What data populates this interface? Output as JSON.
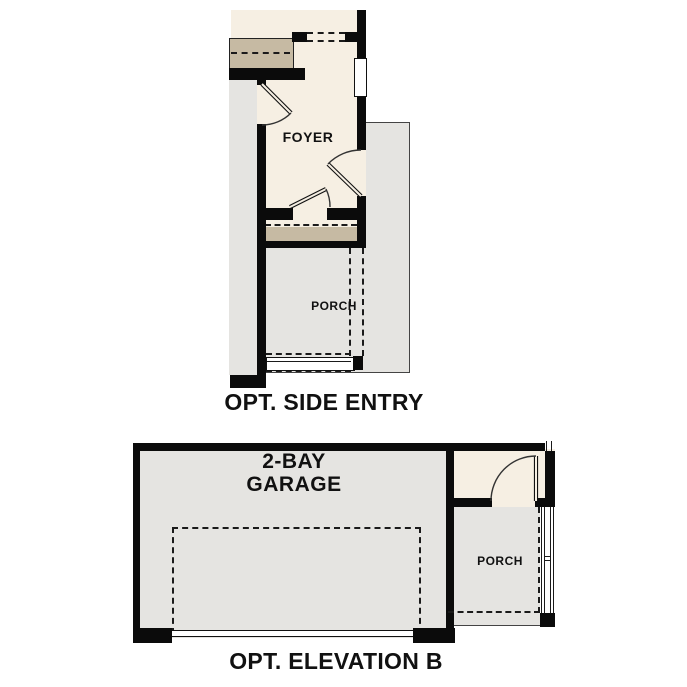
{
  "colors": {
    "background": "#FFFFFF",
    "wall": "#0B0B0B",
    "floor_cream": "#F6EFE3",
    "stair_tan": "#C6BAA3",
    "concrete_gray": "#E5E4E1",
    "line_ink": "#1A1A1A",
    "text": "#111111"
  },
  "side_entry_plan": {
    "title": "OPT. SIDE ENTRY",
    "foyer_label": "FOYER",
    "porch_label": "PORCH"
  },
  "elevation_b_plan": {
    "title": "OPT. ELEVATION B",
    "garage_label": "2-BAY GARAGE",
    "porch_label": "PORCH"
  }
}
